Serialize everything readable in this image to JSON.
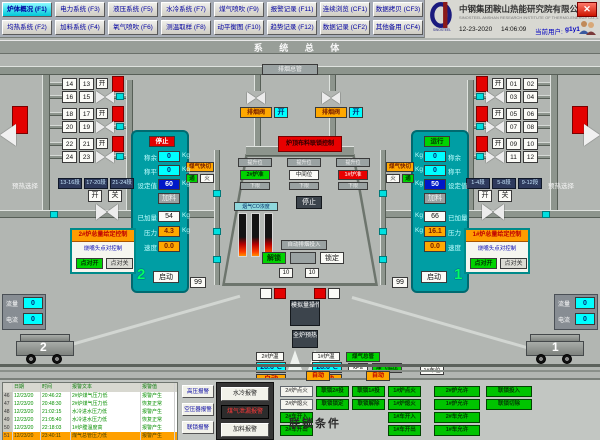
{
  "header": {
    "menu": [
      [
        {
          "label": "炉体概况 (F1)",
          "active": true
        },
        {
          "label": "电力系统 (F3)",
          "active": false
        },
        {
          "label": "液压系统 (F5)",
          "active": false
        },
        {
          "label": "水冷系统 (F7)",
          "active": false
        },
        {
          "label": "煤气喷吹 (F9)",
          "active": false
        },
        {
          "label": "报警记录 (F11)",
          "active": false
        },
        {
          "label": "连续浏览 (CF1)",
          "active": false
        },
        {
          "label": "数据拷贝 (CF3)",
          "active": false
        }
      ],
      [
        {
          "label": "均热系统 (F2)",
          "active": false
        },
        {
          "label": "加料系统 (F4)",
          "active": false
        },
        {
          "label": "氧气喷吹 (F6)",
          "active": false
        },
        {
          "label": "测温取样 (F8)",
          "active": false
        },
        {
          "label": "动平衡图 (F10)",
          "active": false
        },
        {
          "label": "趋势记录 (F12)",
          "active": false
        },
        {
          "label": "数据记录 (CF2)",
          "active": false
        },
        {
          "label": "其他备用 (CF4)",
          "active": false
        }
      ]
    ],
    "company_cn": "中钢集团鞍山热能研究院有限公司",
    "company_en": "SINOSTEEL ANSHAN RESEARCH INSTITUTE OF THERMO-ENERGY CO.,LTD.",
    "logo_caption": "SINOSTEEL",
    "date": "12-23-2020",
    "time": "14:06:09",
    "user_label": "当前用户:",
    "user_name": "g1y1",
    "close_label": "✕"
  },
  "title": "系 统 总 体",
  "colors": {
    "accent_teal": "#009ea4",
    "alarm_red": "#e40000",
    "run_green": "#00d400",
    "value_cyan": "#00ffff",
    "set_blue": "#0018c8",
    "warn_orange": "#ffa800"
  },
  "mimic": {
    "top_pipe_label": "排烟总管",
    "smoke_valve_label": "排烟阀",
    "smoke_valve_status": "开",
    "open_label": "开",
    "close_label": "关",
    "left_dampers": [
      [
        "14",
        "13"
      ],
      [
        "16",
        "15"
      ],
      [
        "18",
        "17"
      ],
      [
        "20",
        "19"
      ],
      [
        "22",
        "21"
      ],
      [
        "24",
        "23"
      ]
    ],
    "right_dampers": [
      [
        "01",
        "02"
      ],
      [
        "03",
        "04"
      ],
      [
        "05",
        "06"
      ],
      [
        "07",
        "08"
      ],
      [
        "09",
        "10"
      ],
      [
        "11",
        "12"
      ]
    ],
    "preheat": {
      "label": "预热选择",
      "left_buttons": [
        "13-16段",
        "17-20段",
        "21-24段"
      ],
      "right_buttons": [
        "1-4段",
        "5-8段",
        "9-12段"
      ]
    },
    "furnace2": {
      "status": "停止",
      "start": "启动",
      "number": "2",
      "rows": [
        {
          "label": "称余",
          "value": "0",
          "unit": "Kg",
          "style": "cyan"
        },
        {
          "label": "称平",
          "value": "0",
          "unit": "Kg",
          "style": "cyan"
        },
        {
          "label": "设定值",
          "value": "60",
          "unit": "Kg",
          "style": "blue"
        },
        {
          "label": "",
          "value": "加料",
          "unit": "",
          "style": "grayv"
        },
        {
          "label": "已加量",
          "value": "54",
          "unit": "Kg",
          "style": "white"
        },
        {
          "label": "压力",
          "value": "4.3",
          "unit": "Kg",
          "style": "orange"
        },
        {
          "label": "速度",
          "value": "0.0",
          "unit": "",
          "style": "orange"
        }
      ]
    },
    "furnace1": {
      "status": "运行",
      "start": "启动",
      "number": "1",
      "rows": [
        {
          "label": "称余",
          "value": "0",
          "unit": "Kg",
          "style": "cyan"
        },
        {
          "label": "称平",
          "value": "0",
          "unit": "Kg",
          "style": "cyan"
        },
        {
          "label": "设定值",
          "value": "50",
          "unit": "Kg",
          "style": "blue"
        },
        {
          "label": "",
          "value": "加料",
          "unit": "",
          "style": "grayv"
        },
        {
          "label": "已加量",
          "value": "66",
          "unit": "Kg",
          "style": "white"
        },
        {
          "label": "压力",
          "value": "16.1",
          "unit": "Kg",
          "style": "orange"
        },
        {
          "label": "速度",
          "value": "0.0",
          "unit": "",
          "style": "orange"
        }
      ]
    },
    "control2": {
      "title": "2#炉总量给定控制",
      "sub": "烧嘴头点对控制",
      "on": "点对开",
      "off": "点对关"
    },
    "control1": {
      "title": "1#炉总量给定控制",
      "sub": "烧嘴头点对控制",
      "on": "点对开",
      "off": "点对关"
    },
    "burner": {
      "label": "煤气快切",
      "on": "通",
      "fire": "火"
    },
    "center": {
      "top_label": "炉顶布料联锁控制",
      "columns": [
        {
          "top": "提升位",
          "mid": "2#炉准",
          "mid_style": "green",
          "bot": "下限"
        },
        {
          "top": "提升位",
          "mid": "中间位",
          "mid_style": "white",
          "bot": "下限"
        },
        {
          "top": "提升位",
          "mid": "1#炉准",
          "mid_style": "red",
          "bot": "下限"
        }
      ],
      "stop": "停止",
      "bars_label": "烟气CO浓度",
      "auto_label": "自动排烟投入",
      "unlock": "解锁",
      "lock": "锁定",
      "val10": "10",
      "val99": "99"
    },
    "temps": {
      "t2_label": "2#炉温",
      "t2": "28.6℃",
      "t1_label": "1#炉温",
      "t1": "28.6℃",
      "mode": "自动"
    },
    "gas": {
      "main_label": "煤气总管",
      "unit": "kPa",
      "low_label": "煤气低压",
      "car_label": "1#车位"
    },
    "left_panel": [
      {
        "label": "流量",
        "value": "0"
      },
      {
        "label": "电流",
        "value": "0"
      }
    ],
    "right_panel": [
      {
        "label": "流量",
        "value": "0"
      },
      {
        "label": "电流",
        "value": "0"
      }
    ],
    "car2": "2",
    "car1": "1"
  },
  "bottom": {
    "table": {
      "headers": [
        "日期",
        "时间",
        "报警文本",
        "报警值"
      ],
      "rows": [
        {
          "num": "46",
          "date": "12/23/20",
          "time": "20:46:22",
          "text": "2#炉煤气压力低",
          "value": "报警产生",
          "selected": false
        },
        {
          "num": "47",
          "date": "12/23/20",
          "time": "20:48:30",
          "text": "2#炉煤气压力低",
          "value": "恢复正常",
          "selected": false
        },
        {
          "num": "48",
          "date": "12/23/20",
          "time": "21:02:15",
          "text": "水冷进水压力低",
          "value": "报警产生",
          "selected": false
        },
        {
          "num": "49",
          "date": "12/23/20",
          "time": "21:05:40",
          "text": "水冷进水压力低",
          "value": "恢复正常",
          "selected": false
        },
        {
          "num": "50",
          "date": "12/23/20",
          "time": "22:18:03",
          "text": "1#炉膛温度高",
          "value": "报警产生",
          "selected": false
        },
        {
          "num": "51",
          "date": "12/23/20",
          "time": "23:40:11",
          "text": "煤气总管压力低",
          "value": "报警产生",
          "selected": true
        }
      ]
    },
    "side_buttons": [
      "高压报警",
      "空压器报警",
      "联锁报警"
    ],
    "alarm_buttons": [
      {
        "label": "水冷报警",
        "style": "light"
      },
      {
        "label": "煤气泄漏报警",
        "style": "dark"
      },
      {
        "label": "加料报警",
        "style": "light"
      }
    ],
    "auto_tags": [
      "自动",
      "自动"
    ],
    "interlock_title": "联锁条件",
    "grid_a": [
      [
        {
          "t": "2#炉点火",
          "c": "w"
        },
        {
          "t": "2#炉熄火",
          "c": "w"
        },
        {
          "t": "2#车开入",
          "c": "g"
        },
        {
          "t": "2#车开出",
          "c": "g"
        }
      ],
      [
        {
          "t": "联锁2#投",
          "c": "g"
        },
        {
          "t": "联锁锁定",
          "c": "g"
        }
      ],
      [
        {
          "t": "联锁1#投",
          "c": "g"
        },
        {
          "t": "联锁解除",
          "c": "g"
        }
      ],
      [
        {
          "t": "1#炉点火",
          "c": "g"
        },
        {
          "t": "1#炉熄火",
          "c": "g"
        },
        {
          "t": "1#车开入",
          "c": "g"
        },
        {
          "t": "1#车开出",
          "c": "g"
        }
      ]
    ],
    "grid_b": [
      [
        {
          "t": "2#炉允许",
          "c": "g"
        },
        {
          "t": "1#炉允许",
          "c": "g"
        },
        {
          "t": "2#车允许",
          "c": "g"
        },
        {
          "t": "1#车允许",
          "c": "g"
        }
      ],
      [
        {
          "t": "联锁投入",
          "c": "g"
        },
        {
          "t": "联锁切除",
          "c": "g"
        }
      ]
    ]
  }
}
